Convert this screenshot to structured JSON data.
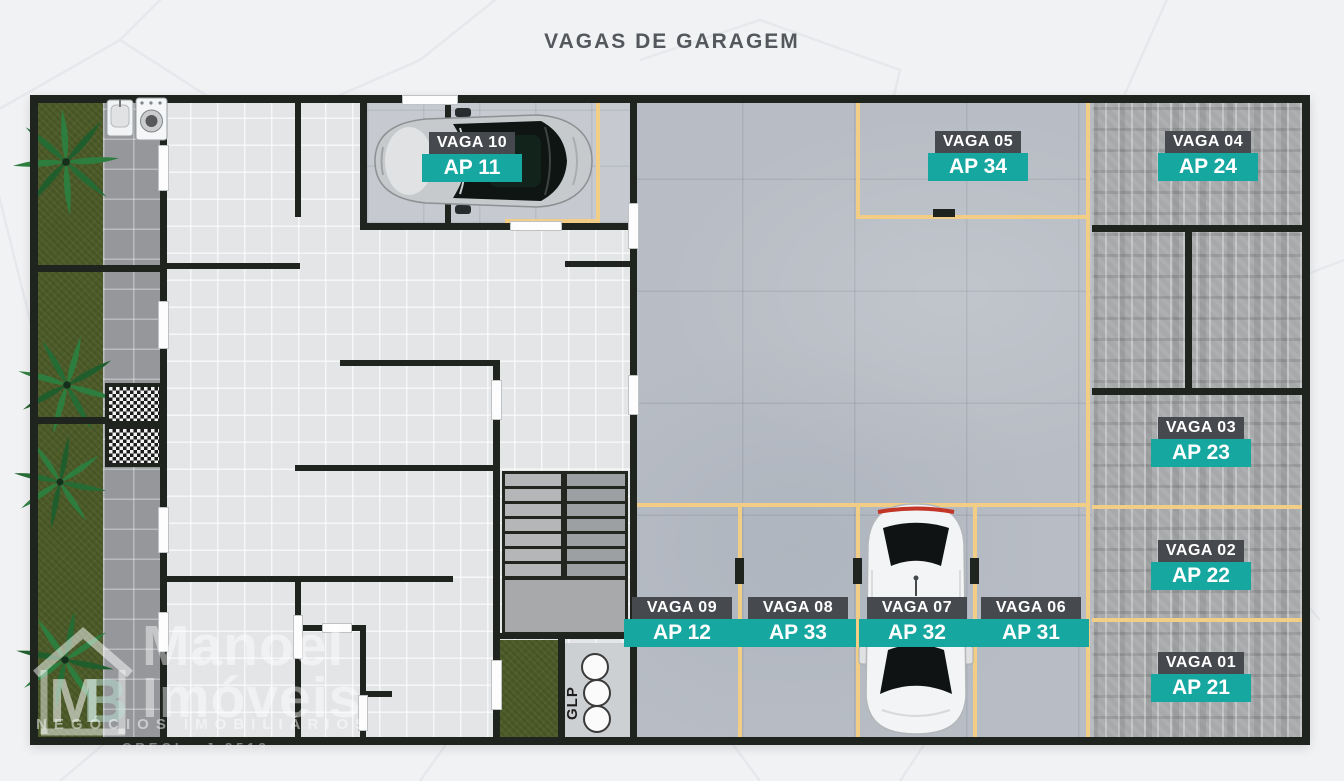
{
  "title": "VAGAS DE GARAGEM",
  "palette": {
    "teal": "#16A8A0",
    "label_dark": "#46494E",
    "wall": "#20241F",
    "parking_line_yellow": "#F1CD85",
    "grass_green": "#4D5C29",
    "concrete": "#B8BDC5",
    "paver": "#A7A9AB",
    "background": "#F1F2F4"
  },
  "spots": [
    {
      "vaga": "VAGA 10",
      "ap": "AP 11"
    },
    {
      "vaga": "VAGA 05",
      "ap": "AP 34"
    },
    {
      "vaga": "VAGA 04",
      "ap": "AP 24"
    },
    {
      "vaga": "VAGA 03",
      "ap": "AP 23"
    },
    {
      "vaga": "VAGA 02",
      "ap": "AP 22"
    },
    {
      "vaga": "VAGA 01",
      "ap": "AP 21"
    },
    {
      "vaga": "VAGA 09",
      "ap": "AP 12"
    },
    {
      "vaga": "VAGA 08",
      "ap": "AP 33"
    },
    {
      "vaga": "VAGA 07",
      "ap": "AP 32"
    },
    {
      "vaga": "VAGA 06",
      "ap": "AP 31"
    }
  ],
  "annotations": {
    "glp": "GLP"
  },
  "watermark": {
    "brand_line1": "Manoel",
    "brand_line2": "Imóveis",
    "monogram_m": "M",
    "monogram_b": "B",
    "tagline": "NEGÓCIOS IMOBILIÁRIOS",
    "creci": "CRECI - J 8513"
  }
}
